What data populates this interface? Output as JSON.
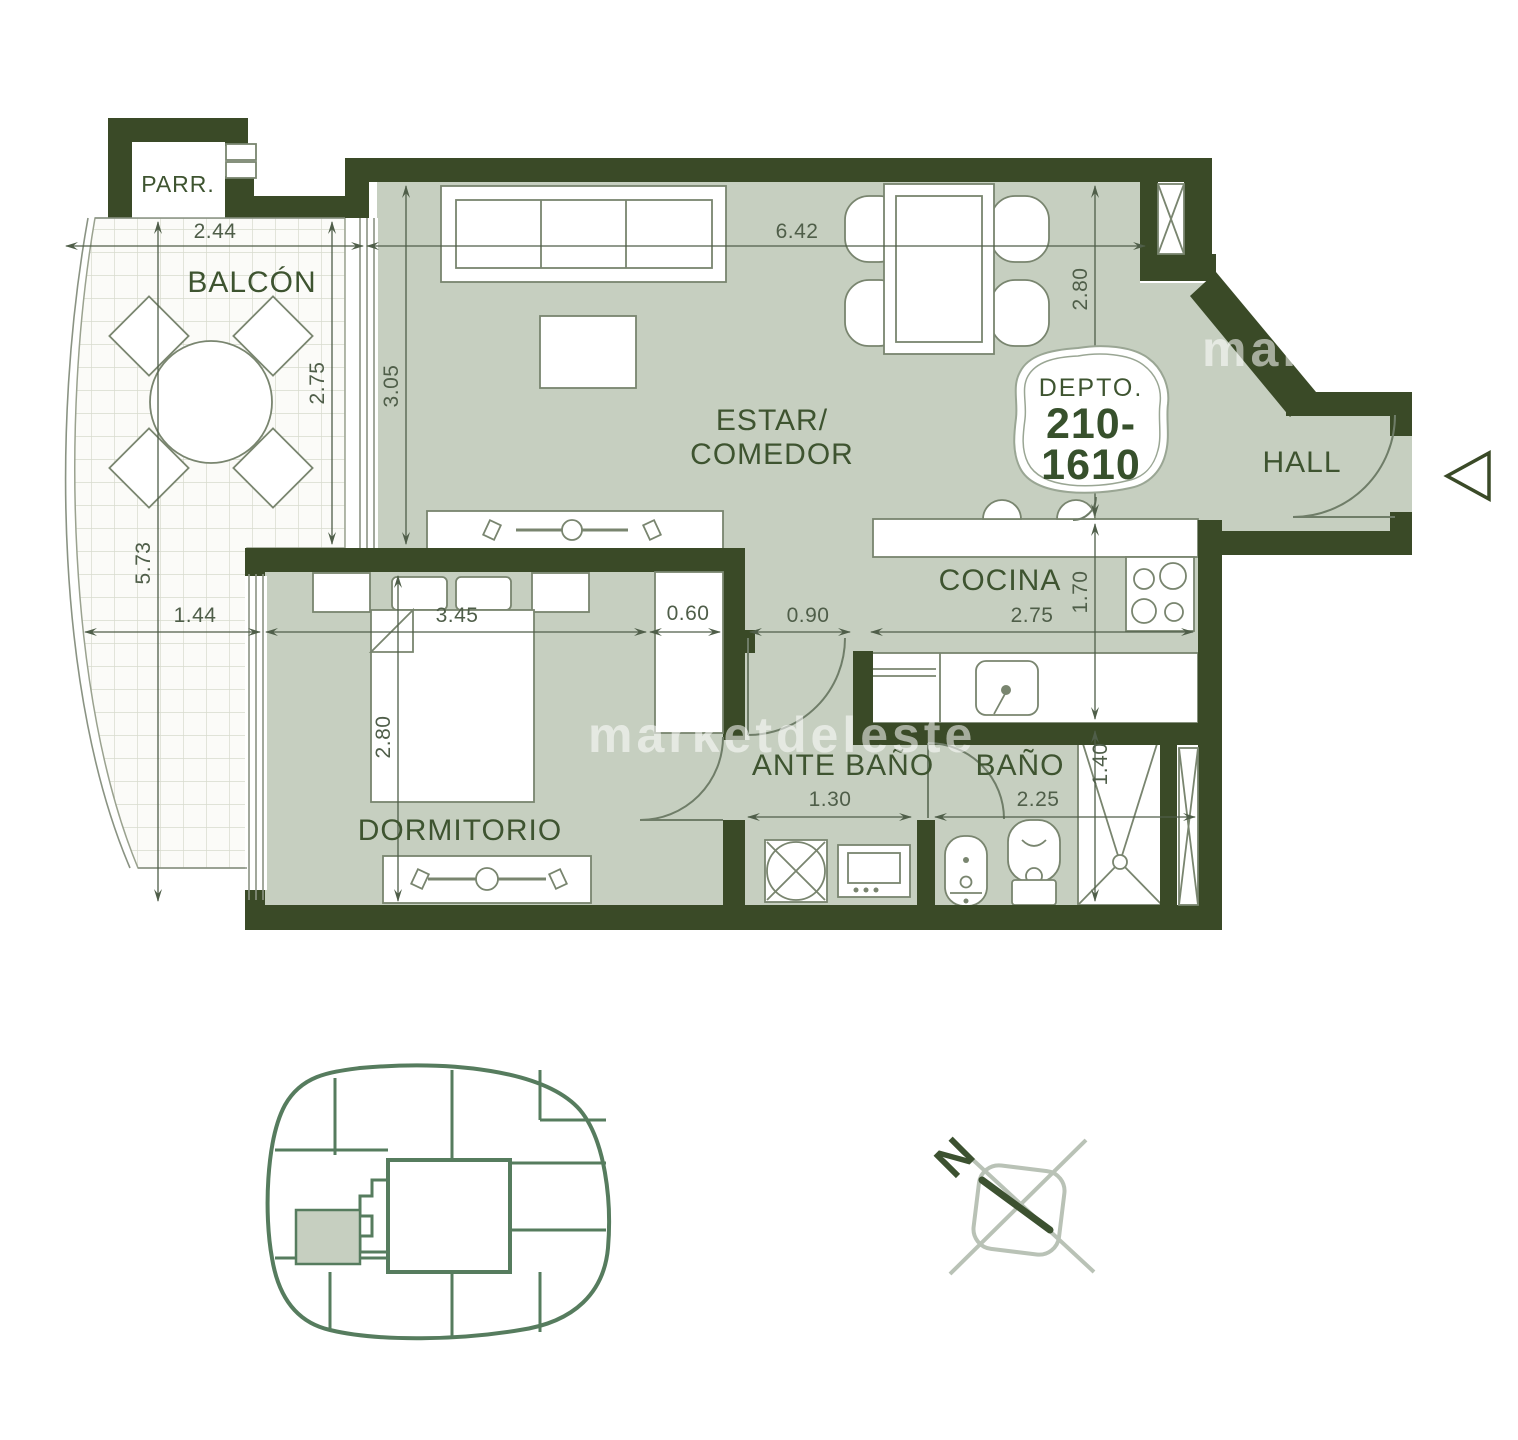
{
  "plan": {
    "labels": {
      "parr": "PARR.",
      "balcon": "BALCÓN",
      "estar1": "ESTAR/",
      "estar2": "COMEDOR",
      "cocina": "COCINA",
      "hall": "HALL",
      "dormitorio": "DORMITORIO",
      "ante_bano": "ANTE BAÑO",
      "bano": "BAÑO"
    },
    "badge": {
      "title": "DEPTO.",
      "num1": "210-",
      "num2": "1610"
    },
    "dims": {
      "balcony_width": "2.44",
      "living_width": "6.42",
      "balcony_depth": "2.75",
      "living_depth": "3.05",
      "balcony_length": "5.73",
      "dining_depth": "2.80",
      "kitchen_depth": "1.70",
      "balcony_lower_width": "1.44",
      "dorm_width": "3.45",
      "closet_width": "0.60",
      "passage_width": "0.90",
      "kitchen_width": "2.75",
      "antebano_width": "1.30",
      "bano_width": "2.25",
      "shower_width": "1.40",
      "dorm_depth": "2.80"
    },
    "watermark": "marketdeleste",
    "compass_north": "N"
  },
  "colors": {
    "wall": "#3a4a27",
    "room_fill": "#c6cfc0",
    "label": "#3e5430",
    "dimension": "#4f5e49",
    "furniture_stroke": "#79856f",
    "footprint_green": "#567c5e",
    "compass_gray": "#b9c2b6",
    "tile_line": "#d7dbce"
  }
}
